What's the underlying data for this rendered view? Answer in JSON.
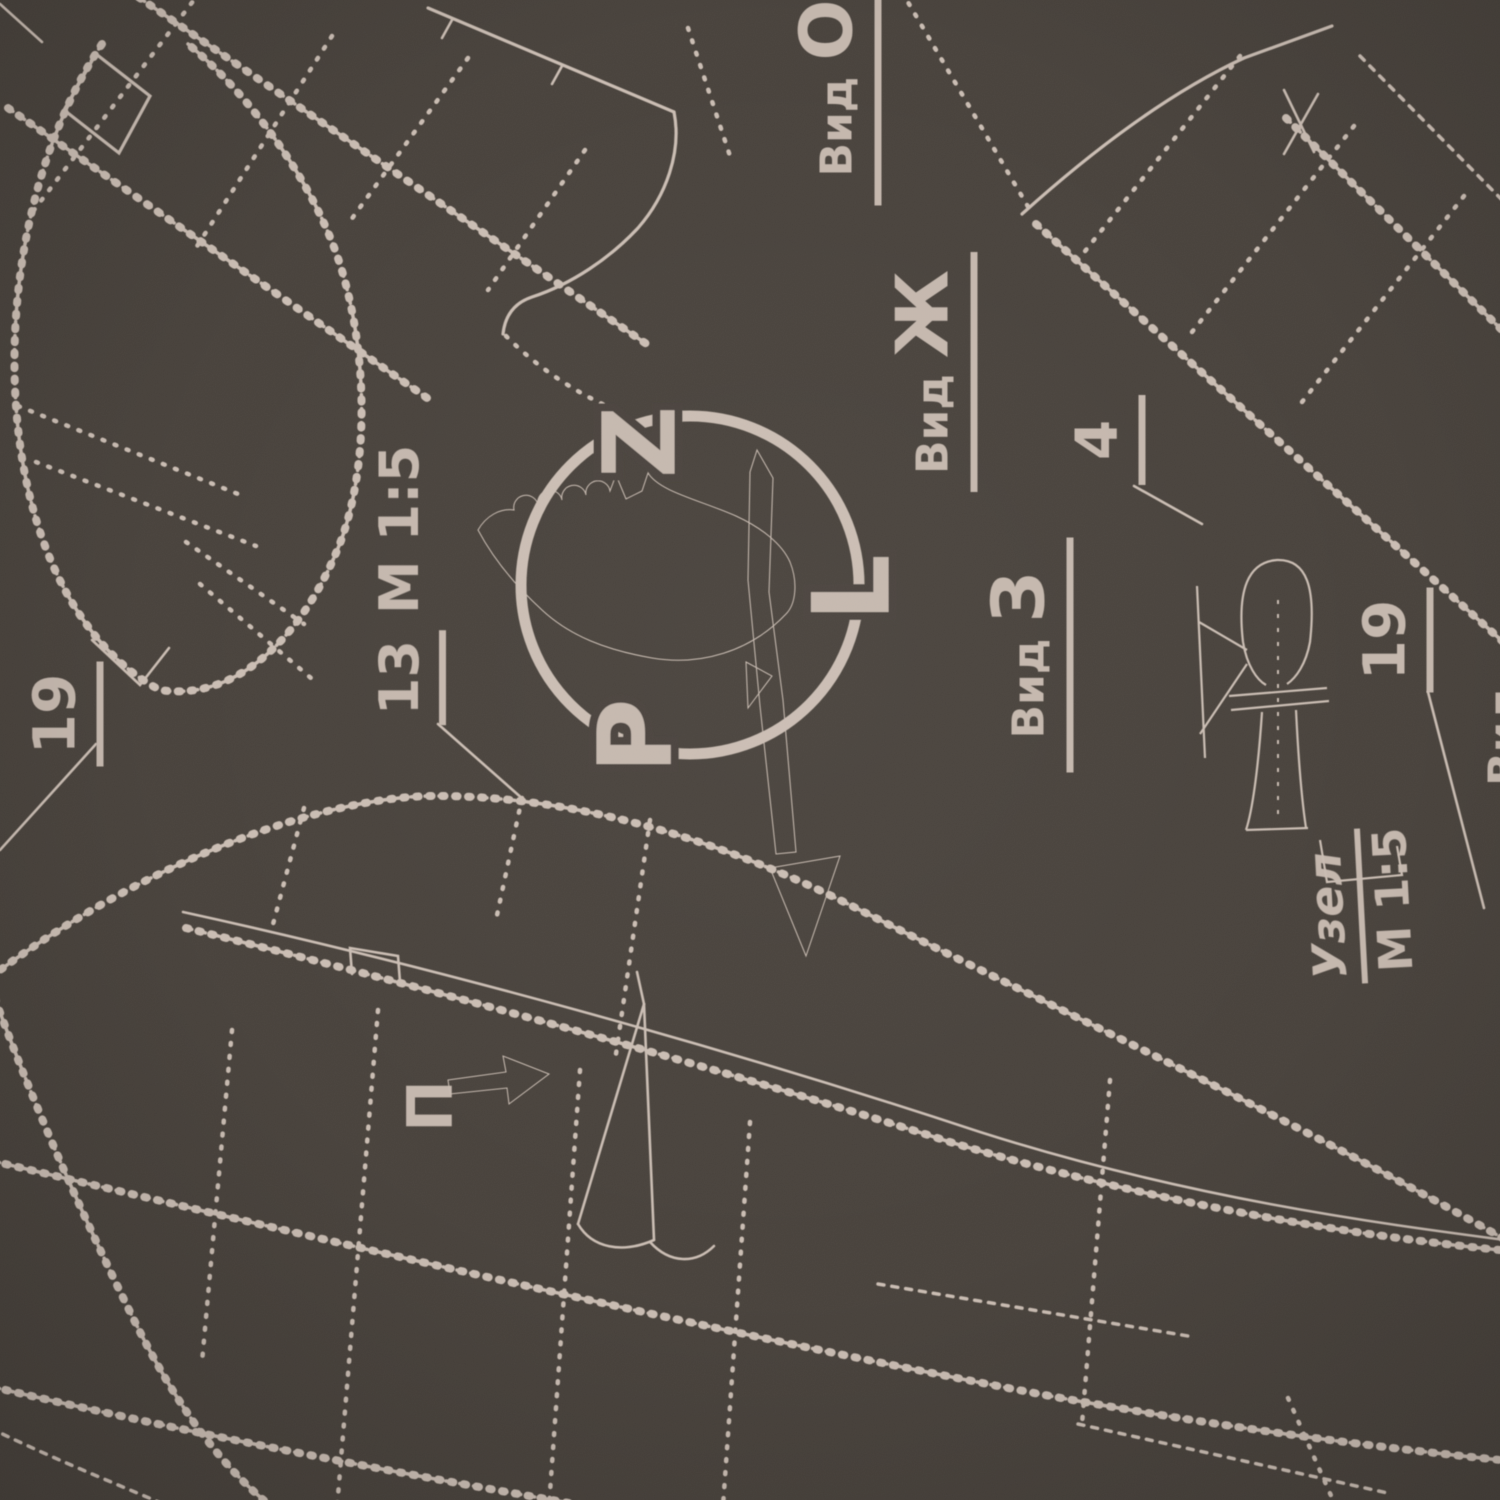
{
  "artwork": {
    "type": "aviation-blueprint-pattern",
    "colors": {
      "background": "#48423c",
      "line": "#cabdb3",
      "line_dim": "#9d9189",
      "logo": "#c5b8ae"
    },
    "logo": {
      "name": "PZL winged emblem",
      "letters": [
        "Z",
        "L",
        "P"
      ]
    },
    "labels": {
      "vid_o": {
        "prefix": "Вид",
        "letter": "О"
      },
      "vid_zh": {
        "prefix": "Вид",
        "letter": "Ж"
      },
      "vid_z": {
        "prefix": "Вид",
        "letter": "З"
      },
      "callout_13": {
        "number": "13",
        "scale": "М 1:5"
      },
      "uzel": {
        "word": "Узел",
        "scale": "М 1:5"
      },
      "num_4": "4",
      "num_19_left": "19",
      "num_19_right": "19",
      "marker_p": "П",
      "partial_vid": "Вид"
    }
  }
}
